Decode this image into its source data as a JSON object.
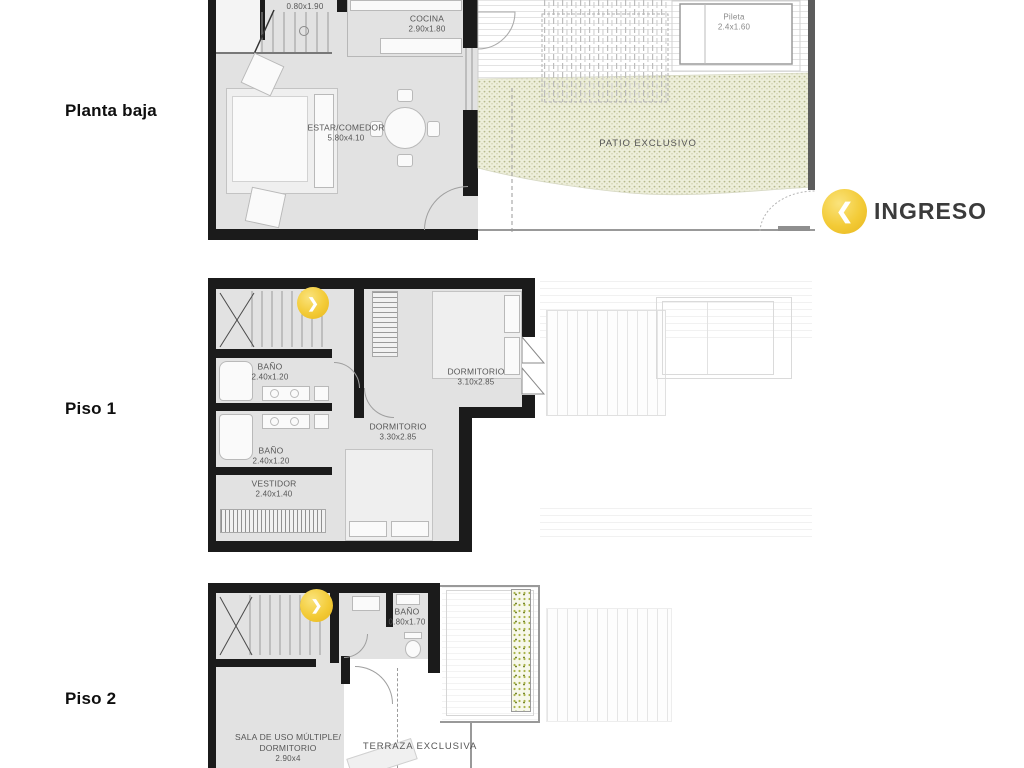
{
  "labels": {
    "planta_baja": "Planta baja",
    "piso_1": "Piso 1",
    "piso_2": "Piso 2"
  },
  "ingreso": {
    "label": "INGRESO",
    "icon": "❮"
  },
  "icons": {
    "floor_link": "❯"
  },
  "pb": {
    "toilette": {
      "dims": "0.80x1.90"
    },
    "cocina": {
      "name": "COCINA",
      "dims": "2.90x1.80"
    },
    "estar_comedor": {
      "name": "ESTAR/COMEDOR",
      "dims": "5.80x4.10"
    },
    "pileta": {
      "name": "Pileta",
      "dims": "2.4x1.60"
    },
    "patio": {
      "name": "PATIO EXCLUSIVO"
    }
  },
  "p1": {
    "dormitorio_1": {
      "name": "DORMITORIO",
      "dims": "3.10x2.85"
    },
    "dormitorio_2": {
      "name": "DORMITORIO",
      "dims": "3.30x2.85"
    },
    "bano_1": {
      "name": "BAÑO",
      "dims": "2.40x1.20"
    },
    "bano_2": {
      "name": "BAÑO",
      "dims": "2.40x1.20"
    },
    "vestidor": {
      "name": "VESTIDOR",
      "dims": "2.40x1.40"
    }
  },
  "p2": {
    "bano": {
      "name": "BAÑO",
      "dims": "0.80x1.70"
    },
    "sala": {
      "name_line1": "SALA DE USO MÚLTIPLE/",
      "name_line2": "DORMITORIO",
      "dims": "2.90x4"
    },
    "terraza": {
      "name": "TERRAZA EXCLUSIVA"
    }
  },
  "colors": {
    "accent_gold": "#f2c838",
    "wall": "#1b1b1b",
    "floor_fill": "#e2e2e2",
    "patio_fill": "#edeeda",
    "patio_dot": "#b7ba8e",
    "label_text": "#565656",
    "ingreso_text": "#3b3b3b",
    "planter_green": "#a9b34a"
  }
}
